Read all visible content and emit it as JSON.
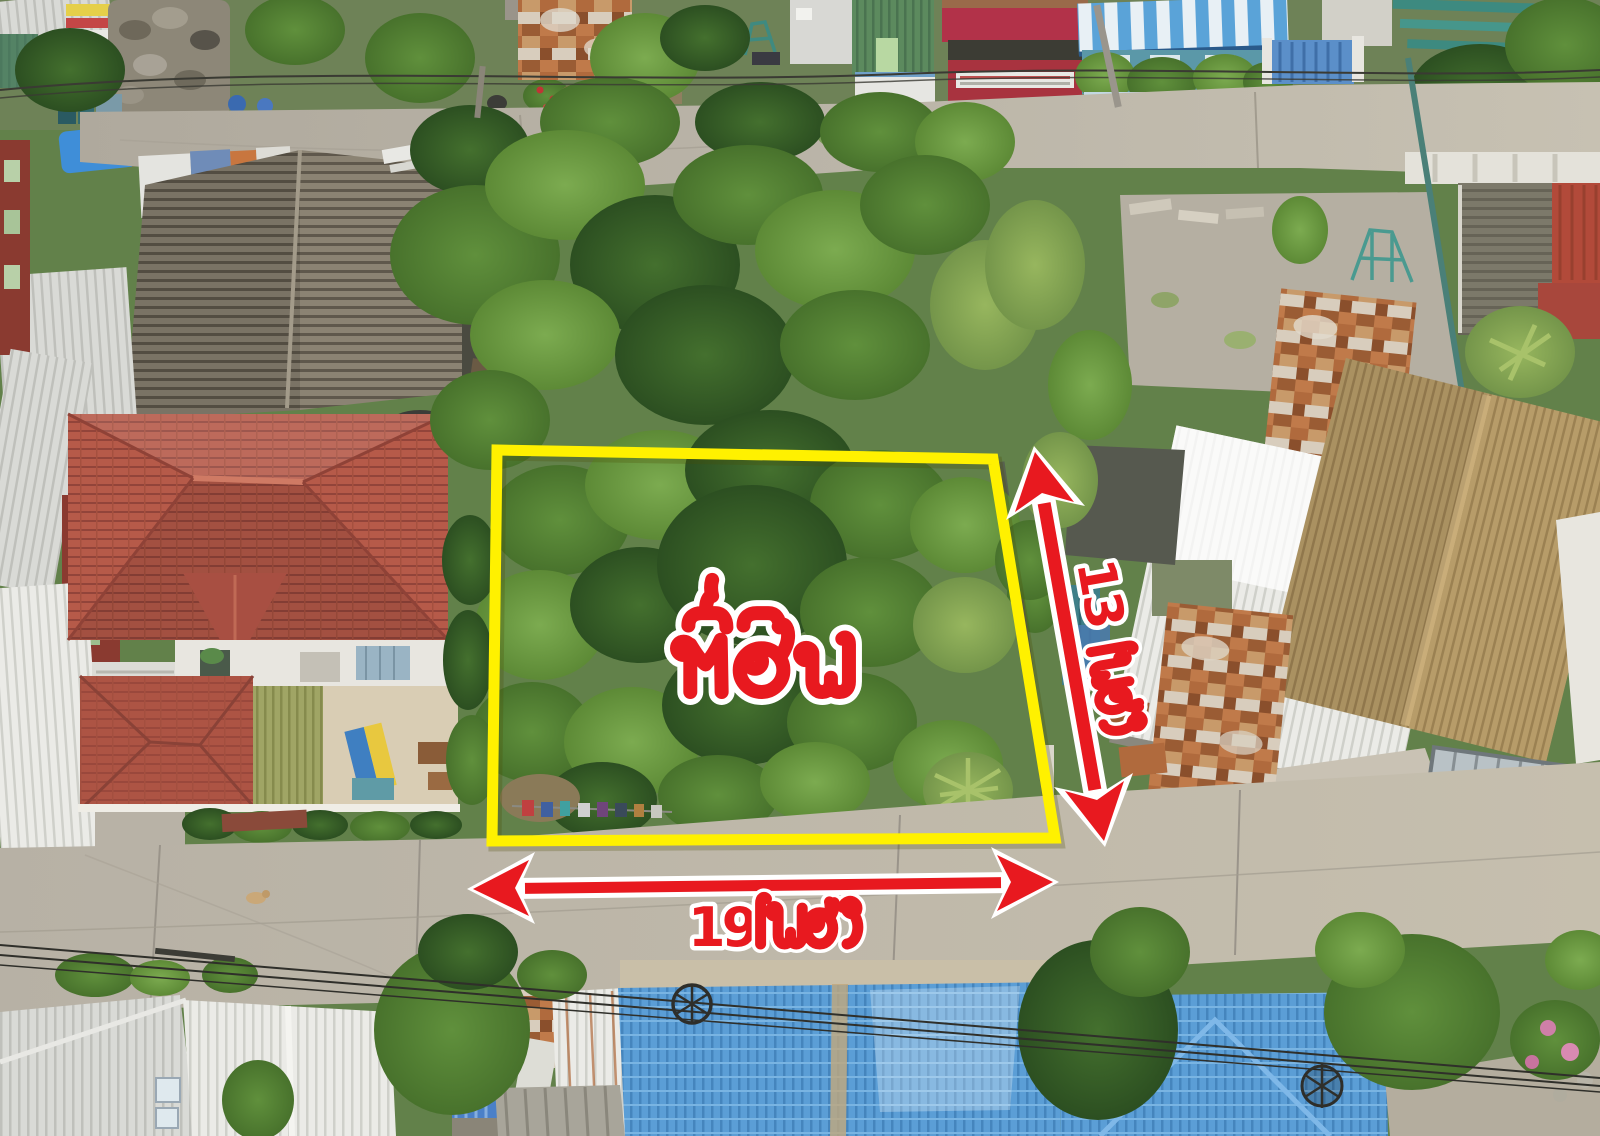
{
  "image": {
    "kind": "aerial-drone-photo",
    "subject": "vacant overgrown land plot outlined for sale between residential houses and two concrete lanes"
  },
  "annotations": {
    "plot_label": {
      "text": "ที่ดิน",
      "text_color": "#e8191f",
      "outline_color": "#ffffff"
    },
    "width": {
      "value": "19",
      "unit": "เมตร",
      "full_text": "19 เมตร"
    },
    "depth": {
      "value": "13",
      "unit": "เมตร",
      "full_text": "13 เมตร"
    },
    "boundary_color": "#fff100",
    "arrow_color": "#e8191f",
    "arrow_outline_color": "#ffffff"
  }
}
